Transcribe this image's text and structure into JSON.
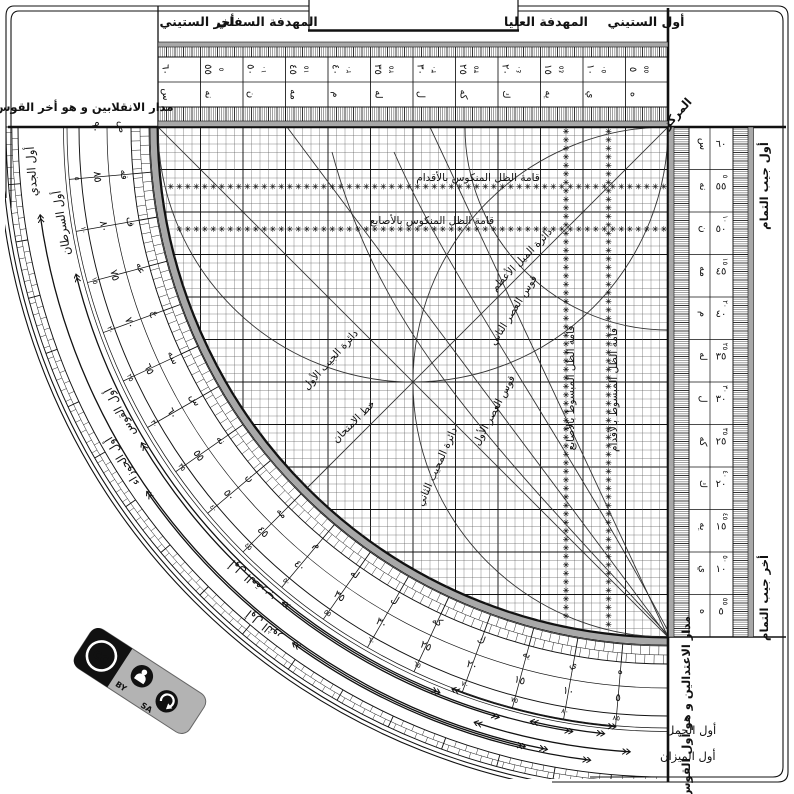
{
  "title": "sine-quadrant-plate",
  "tabs": {
    "akhir_sittini": "أخر الستيني",
    "mihdafa_sufla": "المهدفة السفلي",
    "mihdafa_ulya": "المهدفة العليا",
    "awwal_sittini": "أول الستيني"
  },
  "corner": {
    "markaz": "المركز"
  },
  "side_labels": {
    "madar_inqilabayn": "مدار الانقلابين و هو أخر القوس",
    "madar_itidalayn": "مدار الاعتدالين و هو أول القوس",
    "awwal_jayb_tamam": "أول جيب التمام",
    "akhir_jayb_tamam": "أخر جيب التمام"
  },
  "grid_labels": {
    "qama_mankus_aqdam": "قامة الظل المنكوس بالأقدام",
    "qama_mankus_asabi": "قامة الظل المنكوس بالأصابع",
    "qama_mabsut_asabi": "قامة الظل المبسوط بالأصابع",
    "qama_mabsut_aqdam": "قامة الظل المبسوط بالأقدام",
    "daira_mayl_azam": "دائرة الميل الأعظم",
    "qaws_asr_thani": "قوس العصر الثاني",
    "qaws_asr_awwal": "قوس العصر الأول",
    "daira_jayb_awwal": "دائرة الجيب الأول",
    "daira_mujib_thani": "دائرة المجيب الثاني",
    "khat_imtihan": "خط الامتحان"
  },
  "zodiac": [
    {
      "label": "أول الجدي"
    },
    {
      "label": "أول السرطان"
    },
    {
      "label": "أول الجوزاء"
    },
    {
      "label": "أول القوس"
    },
    {
      "label": "أول الثور"
    },
    {
      "label": "أول العقرب"
    },
    {
      "label": "أول الحمل"
    },
    {
      "label": "أول الميزان"
    }
  ],
  "scales": {
    "values": [
      "٥",
      "١٠",
      "١٥",
      "٢٠",
      "٢٥",
      "٣٠",
      "٣٥",
      "٤٠",
      "٤٥",
      "٥٠",
      "٥٥",
      "٦٠"
    ],
    "letters": [
      "ه",
      "ي",
      "يه",
      "ك",
      "كه",
      "ل",
      "له",
      "م",
      "مه",
      "ن",
      "نه",
      "س"
    ],
    "arc_values": [
      "٥",
      "١٠",
      "١٥",
      "٢٠",
      "٢٥",
      "٣٠",
      "٣٥",
      "٤٠",
      "٤٥",
      "٥٠",
      "٥٥",
      "٦٠",
      "٦٥",
      "٧٠",
      "٧٥",
      "٨٠",
      "٨٥",
      "٩٠"
    ],
    "arc_letters": [
      "ه",
      "ي",
      "يه",
      "ك",
      "كه",
      "ل",
      "له",
      "م",
      "مه",
      "ن",
      "نه",
      "س",
      "سه",
      "ع",
      "عه",
      "ف",
      "فه",
      "ص"
    ]
  },
  "cc_badge": {
    "cc": "cc",
    "by": "BY",
    "sa": "SA"
  },
  "colors": {
    "ink": "#111111",
    "band_gray": "#a8a8a8",
    "minor_grid": "#555555",
    "badge_gray": "#b3b3b3",
    "badge_black": "#111111"
  }
}
